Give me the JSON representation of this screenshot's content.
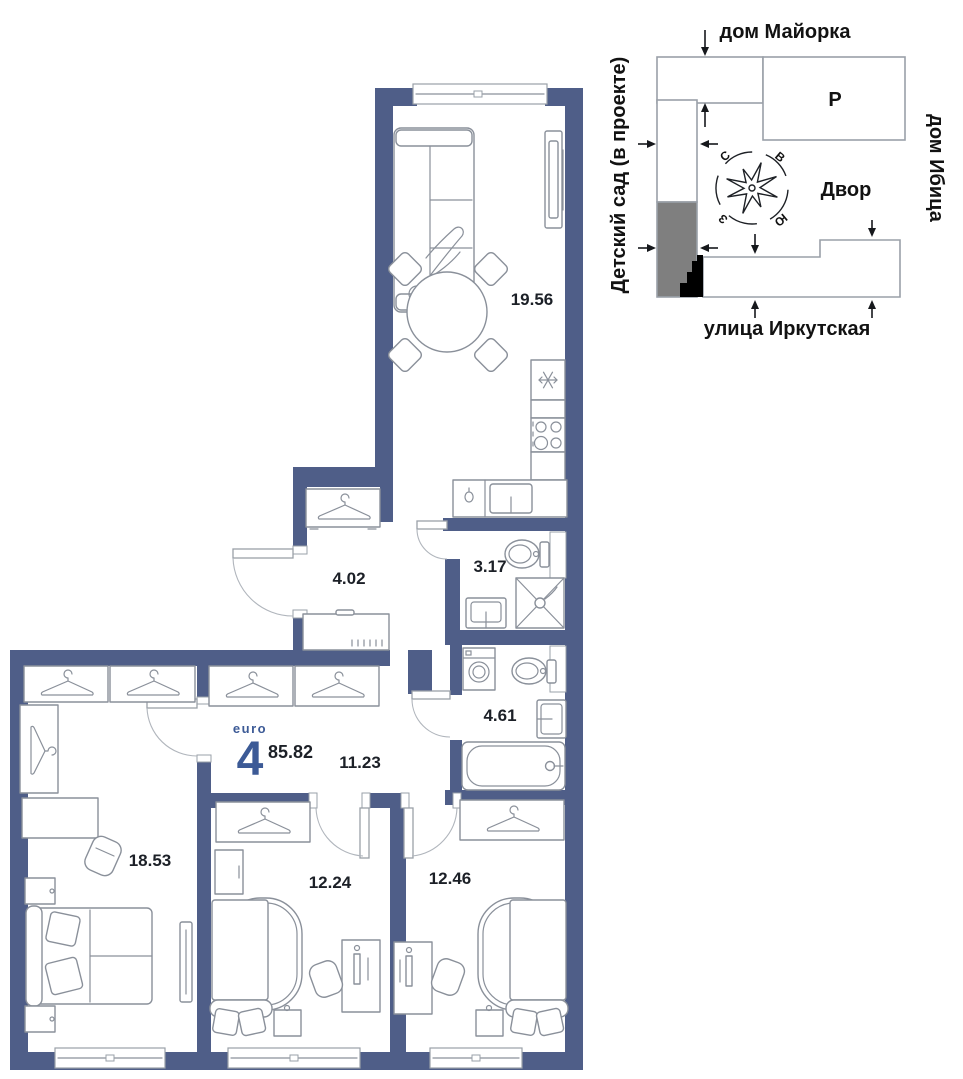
{
  "colors": {
    "wall": "#4f5e88",
    "accent": "#3c5a96",
    "line": "#8a909a",
    "text": "#1c2027",
    "site_line": "#9aa0a8",
    "site_gray": "#7f7f7f",
    "site_black": "#000000"
  },
  "plan": {
    "type_label": "euro",
    "type_number": "4",
    "total_area": "85.82",
    "areas": {
      "living_kitchen": "19.56",
      "hallway": "4.02",
      "bathroom_small": "3.17",
      "bathroom_large": "4.61",
      "corridor": "11.23",
      "bedroom_left": "18.53",
      "bedroom_middle": "12.24",
      "bedroom_right": "12.46"
    }
  },
  "site_plan": {
    "labels": {
      "top": "дом Майорка",
      "left": "Детский сад (в проекте)",
      "right": "дом Ибица",
      "bottom": "улица Иркутская",
      "courtyard": "Двор",
      "parking": "Р"
    },
    "compass": {
      "n": "С",
      "e": "В",
      "s": "Ю",
      "w": "З"
    }
  }
}
